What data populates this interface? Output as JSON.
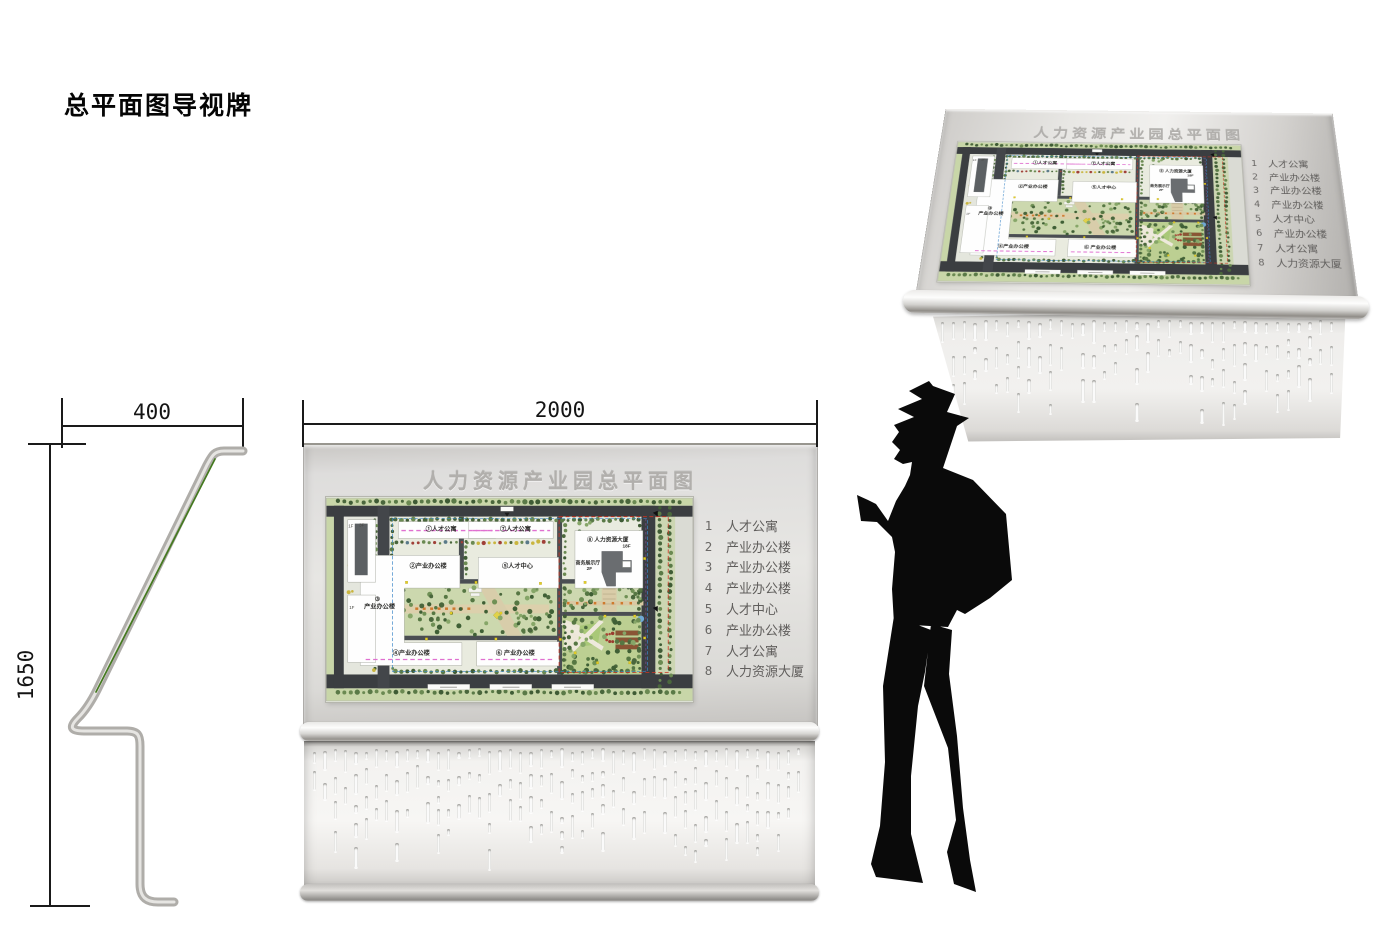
{
  "page": {
    "title": "总平面图导视牌"
  },
  "dims": {
    "front_width": "2000",
    "side_depth": "400",
    "side_height": "1650"
  },
  "panel": {
    "title": "人力资源产业园总平面图",
    "legend": [
      {
        "num": "1",
        "label": "人才公寓"
      },
      {
        "num": "2",
        "label": "产业办公楼"
      },
      {
        "num": "3",
        "label": "产业办公楼"
      },
      {
        "num": "4",
        "label": "产业办公楼"
      },
      {
        "num": "5",
        "label": "人才中心"
      },
      {
        "num": "6",
        "label": "产业办公楼"
      },
      {
        "num": "7",
        "label": "人才公寓"
      },
      {
        "num": "8",
        "label": "人力资源大厦"
      }
    ]
  },
  "map": {
    "labels": {
      "b1": "①人才公寓",
      "b7": "⑦人才公寓",
      "b2": "②产业办公楼",
      "b5": "⑤人才中心",
      "b3_num": "③",
      "b3_name": "产业办公楼",
      "b4": "④产业办公楼",
      "b6": "⑥ 产业办公楼",
      "b8": "⑧ 人力资源大厦",
      "b8_floor": "18F",
      "hall": "商务展示厅",
      "hall_floor": "2F",
      "f3": "3F",
      "f1": "1F",
      "f1b": "1F"
    }
  },
  "colors": {
    "panel_gray": "#e2e1de",
    "title_gray": "#b1afac",
    "legend_gray": "#605e5c",
    "map_red_dash": "#cc3322",
    "map_blue_dash": "#3a86c8",
    "map_magenta_dash": "#e070d0",
    "map_purple_dash": "#8a4fa0",
    "silhouette_black": "#0a0a0a"
  }
}
